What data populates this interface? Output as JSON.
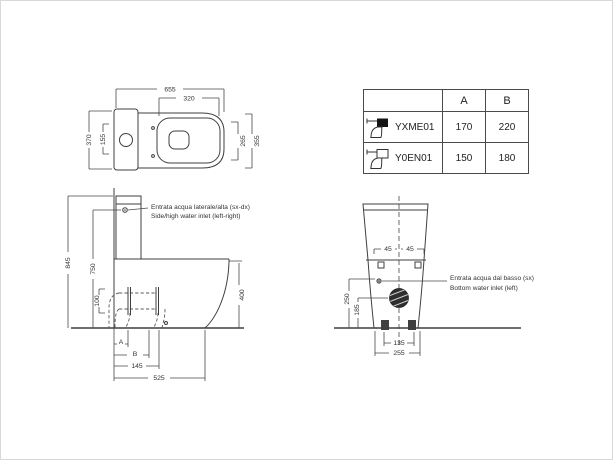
{
  "table": {
    "headers": {
      "a": "A",
      "b": "B"
    },
    "rows": [
      {
        "model": "YXME01",
        "a": "170",
        "b": "220",
        "icon": "toilet-filled-tank-icon"
      },
      {
        "model": "Y0EN01",
        "a": "150",
        "b": "180",
        "icon": "toilet-outline-tank-icon"
      }
    ]
  },
  "top_view": {
    "dim_total_length": "655",
    "dim_seat_length": "320",
    "dim_total_width": "370",
    "dim_tank_inner": "155",
    "dim_seat_width_inner": "265",
    "dim_seat_width_outer": "355"
  },
  "side_view": {
    "dim_total_height": "845",
    "dim_inlet_height": "750",
    "dim_outlet_height": "100",
    "dim_bowl_height": "400",
    "dim_label_a": "A",
    "dim_label_b": "B",
    "dim_outlet_distance": "145",
    "dim_total_depth": "525",
    "note_it": "Entrata acqua laterale/alta (sx-dx)",
    "note_en": "Side/high water inlet (left-right)"
  },
  "front_view": {
    "dim_bolt_left": "45",
    "dim_bolt_right": "45",
    "dim_inlet_height": "250",
    "dim_drain_height": "185",
    "dim_bolt_spacing": "135",
    "dim_base_width": "255",
    "note_it": "Entrata acqua dal basso (sx)",
    "note_en": "Bottom water inlet (left)"
  },
  "colors": {
    "line": "#3f3f3f",
    "text": "#333333",
    "background": "#ffffff"
  }
}
